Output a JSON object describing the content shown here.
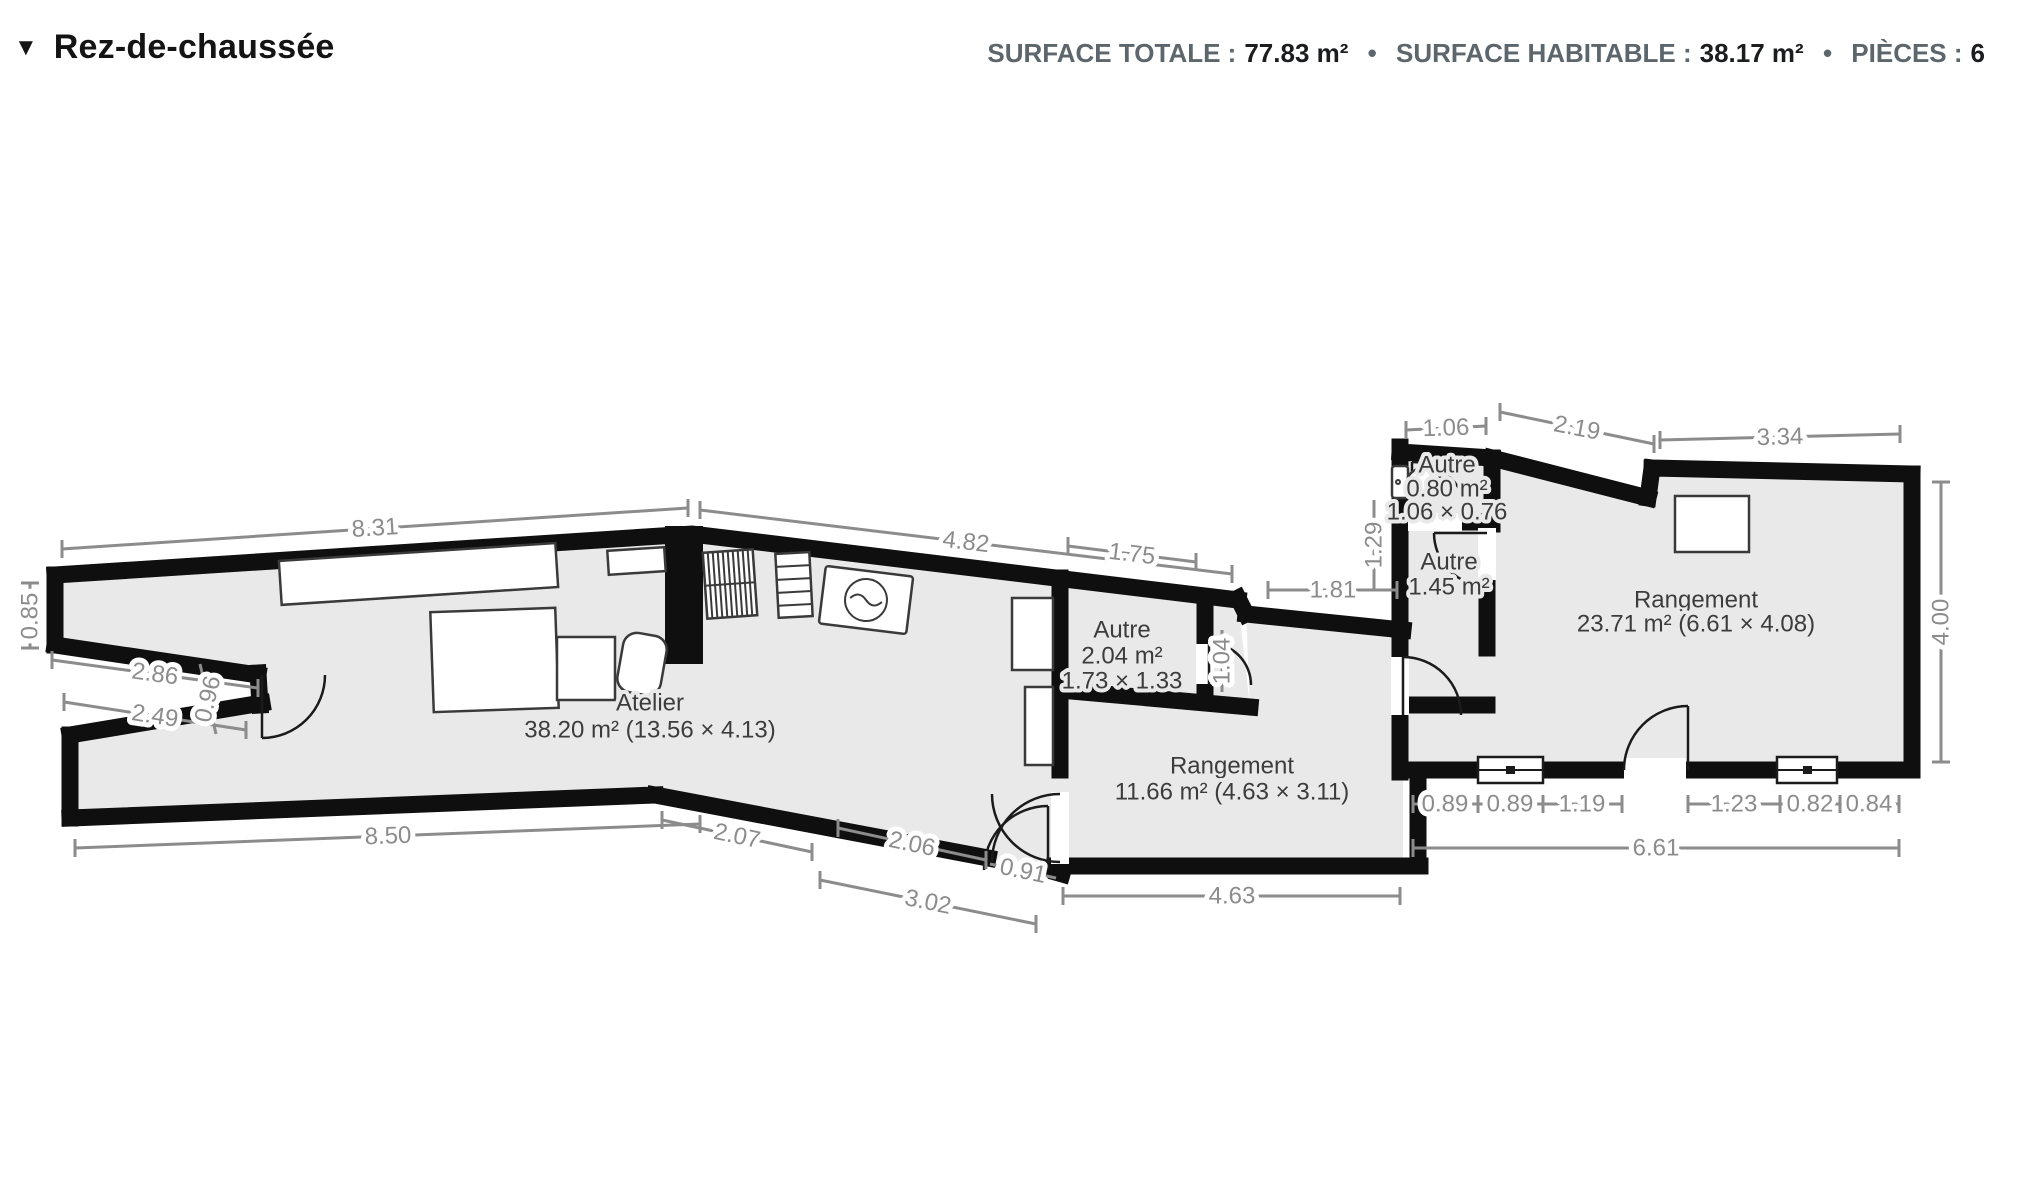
{
  "header": {
    "collapse_icon": "▼",
    "floor_label": "Rez-de-chaussée",
    "separator": "•",
    "stats": [
      {
        "label": "SURFACE TOTALE :",
        "value": "77.83 m²"
      },
      {
        "label": "SURFACE HABITABLE :",
        "value": "38.17 m²"
      },
      {
        "label": "PIÈCES :",
        "value": "6"
      }
    ]
  },
  "rooms": [
    {
      "name": "Atelier",
      "line2": "38.20 m² (13.56 × 4.13)"
    },
    {
      "name": "Autre",
      "line2": "2.04 m²",
      "line3": "1.73 × 1.33"
    },
    {
      "name": "Rangement",
      "line2": "11.66 m² (4.63 × 3.11)"
    },
    {
      "name": "Autre",
      "line2": "0.80 m²",
      "line3": "1.06 × 0.76"
    },
    {
      "name": "Autre",
      "line2": "1.45 m²"
    },
    {
      "name": "Rangement",
      "line2": "23.71 m² (6.61 × 4.08)"
    }
  ],
  "dims": {
    "top_atelier": "8.31",
    "top_middle": "4.82",
    "left_upper": "0.85",
    "notch_upper": "2.86",
    "notch_lower": "2.49",
    "notch_depth": "0.96",
    "bottom_atelier": "8.50",
    "bottom_step1": "2.07",
    "bottom_step2": "2.06",
    "bottom_diag_total": "3.02",
    "bottom_door": "0.91",
    "bottom_mid": "4.63",
    "top_autre": "1.75",
    "autre_door": "1.04",
    "passage_top": "1.81",
    "wc_left": "1.29",
    "wc_top": "1.06",
    "top_diag": "2.19",
    "top_right": "3.34",
    "right_side": "4.00",
    "br_1": "0.89",
    "br_2": "0.89",
    "br_3": "1.19",
    "br_4": "1.23",
    "br_5": "0.82",
    "br_6": "0.84",
    "bottom_right_total": "6.61"
  }
}
